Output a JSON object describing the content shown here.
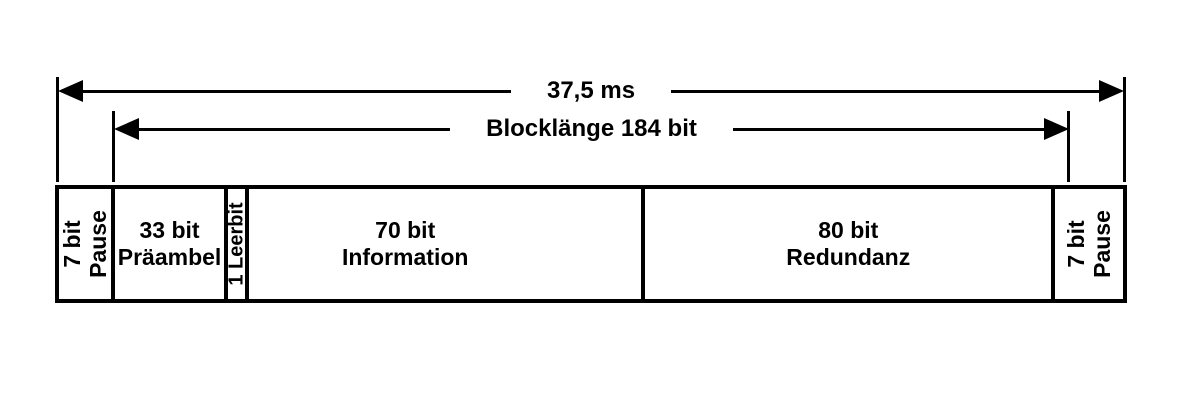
{
  "colors": {
    "ink": "#000000",
    "background": "#ffffff"
  },
  "dimensions": [
    {
      "label": "37,5 ms"
    },
    {
      "label": "Blocklänge 184 bit"
    }
  ],
  "frame": {
    "segments": [
      {
        "name": "pause-left",
        "lines": [
          "7 bit",
          "Pause"
        ]
      },
      {
        "name": "praeambel",
        "lines": [
          "33 bit",
          "Präambel"
        ]
      },
      {
        "name": "leerbit",
        "lines": [
          "1 Leerbit"
        ]
      },
      {
        "name": "information",
        "lines": [
          "70 bit",
          "Information"
        ]
      },
      {
        "name": "redundanz",
        "lines": [
          "80 bit",
          "Redundanz"
        ]
      },
      {
        "name": "pause-right",
        "lines": [
          "7 bit",
          "Pause"
        ]
      }
    ]
  }
}
